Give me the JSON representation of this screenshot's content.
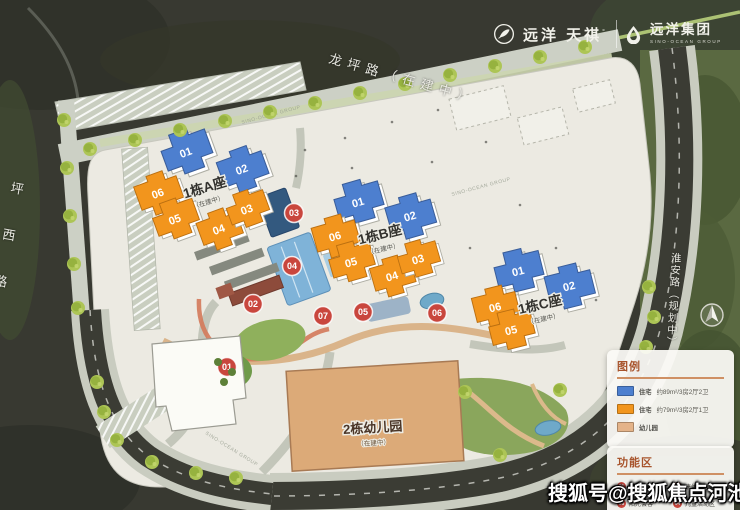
{
  "header": {
    "brand_primary": "远洋 天祺",
    "brand_primary_mark": "°",
    "brand_secondary": "远洋集团",
    "brand_secondary_sub": "SINO-OCEAN GROUP"
  },
  "roads": {
    "top": "龙坪路（在建中）",
    "left": "坪西路",
    "right": "淮安路（规划中）"
  },
  "clusters": {
    "a": {
      "name": "1栋A座",
      "status": "（在建中）"
    },
    "b": {
      "name": "1栋B座",
      "status": "（在建中）"
    },
    "c": {
      "name": "1栋C座",
      "status": "（在建中）"
    },
    "kg": {
      "name": "2栋幼儿园",
      "status": "（在建中）"
    }
  },
  "nums": {
    "01": "01",
    "02": "02",
    "03": "03",
    "04": "04",
    "05": "05",
    "06": "06",
    "07": "07"
  },
  "legend": {
    "title": "图例",
    "items": [
      {
        "swatch": "#4d7fcf",
        "label": "住宅",
        "desc": "约89m²/3房2厅2卫"
      },
      {
        "swatch": "#f2951d",
        "label": "住宅",
        "desc": "约79m²/3房2厅1卫"
      },
      {
        "swatch": "#e4b389",
        "label": "幼儿园",
        "desc": ""
      }
    ]
  },
  "zones": {
    "title": "功能区",
    "items": [
      {
        "num": "01",
        "label": "林荫空间"
      },
      {
        "num": "02",
        "label": "康体健身区"
      },
      {
        "num": "03",
        "label": "阳光会客"
      },
      {
        "num": "04",
        "label": "儿童活动区"
      }
    ]
  },
  "watermark": "搜狐号@搜狐焦点河池站",
  "plan_watermark": "SINO-OCEAN GROUP",
  "colors": {
    "residential_89": "#4d7fcf",
    "residential_79": "#f2951d",
    "kindergarten_fill": "#dcaa78",
    "marker_red": "#c9463d",
    "legend_title": "#a8542c"
  }
}
